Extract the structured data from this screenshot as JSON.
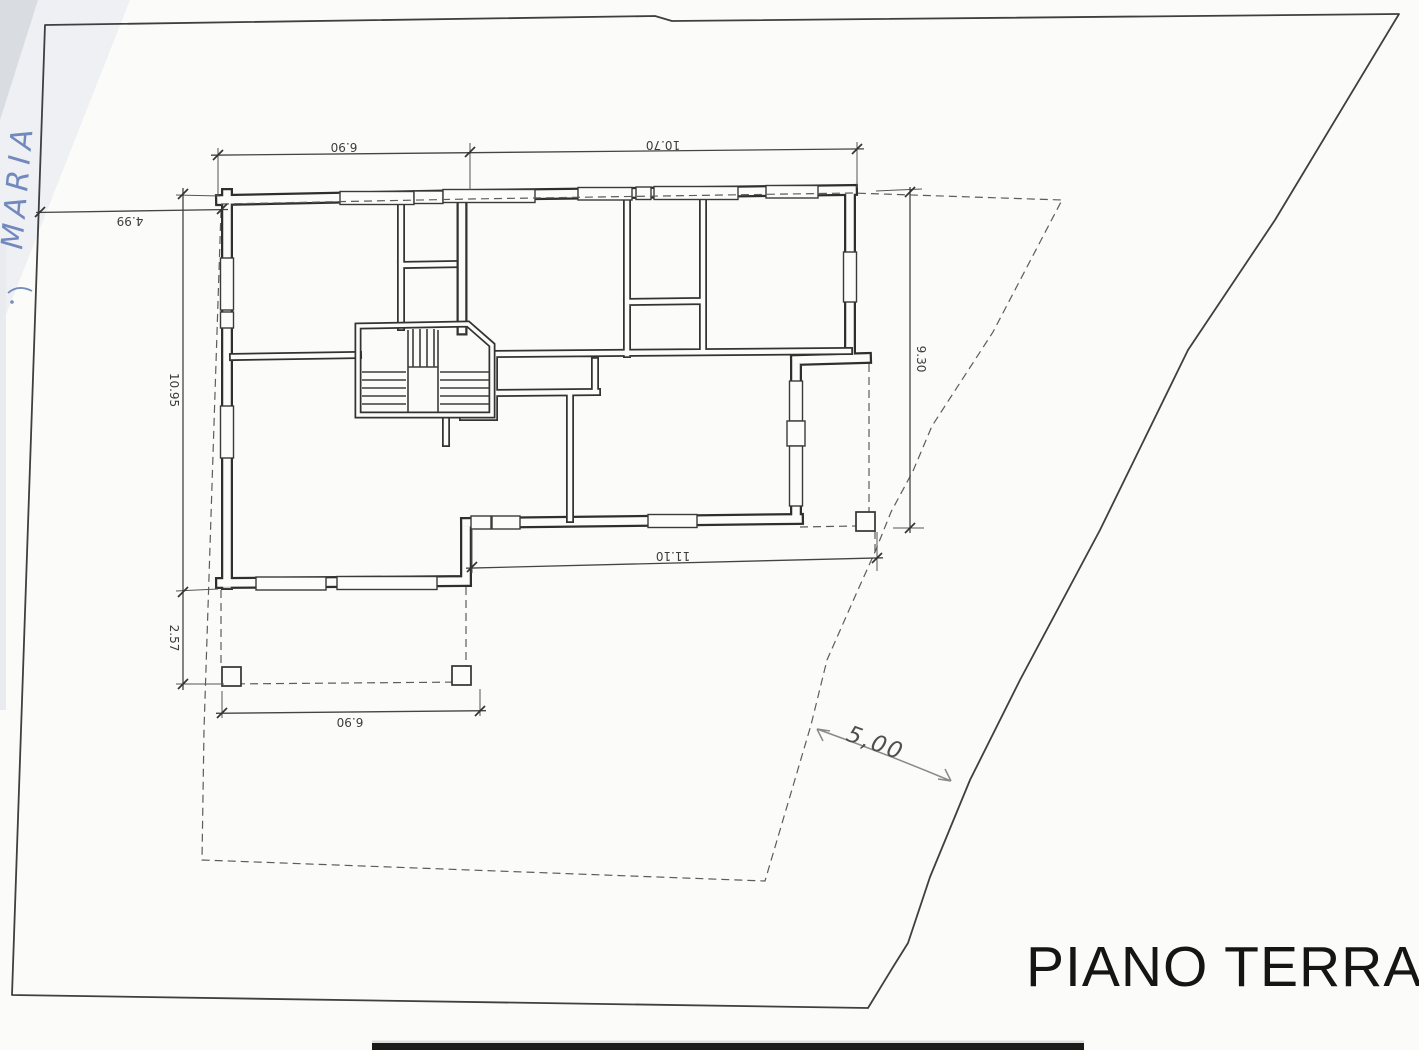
{
  "title": {
    "text": "PIANO TERRA"
  },
  "dimensions": {
    "top_width_left": "6.90",
    "top_width_right": "10.70",
    "site_offset_left": "4.99",
    "left_height_main": "10.95",
    "left_height_porch": "2.57",
    "right_height": "9.30",
    "bottom_width_wing": "11.10",
    "porch_width": "6.90",
    "setback_right_handwritten": "5,00"
  },
  "annotations": {
    "handwritten_note_left": "MARIA"
  },
  "colors": {
    "paper": "#fbfbf9",
    "ink": "#333333",
    "boundary": "#3f3f3f",
    "pencil": "#8a8a8a",
    "pen_blue": "#5d78b5"
  }
}
